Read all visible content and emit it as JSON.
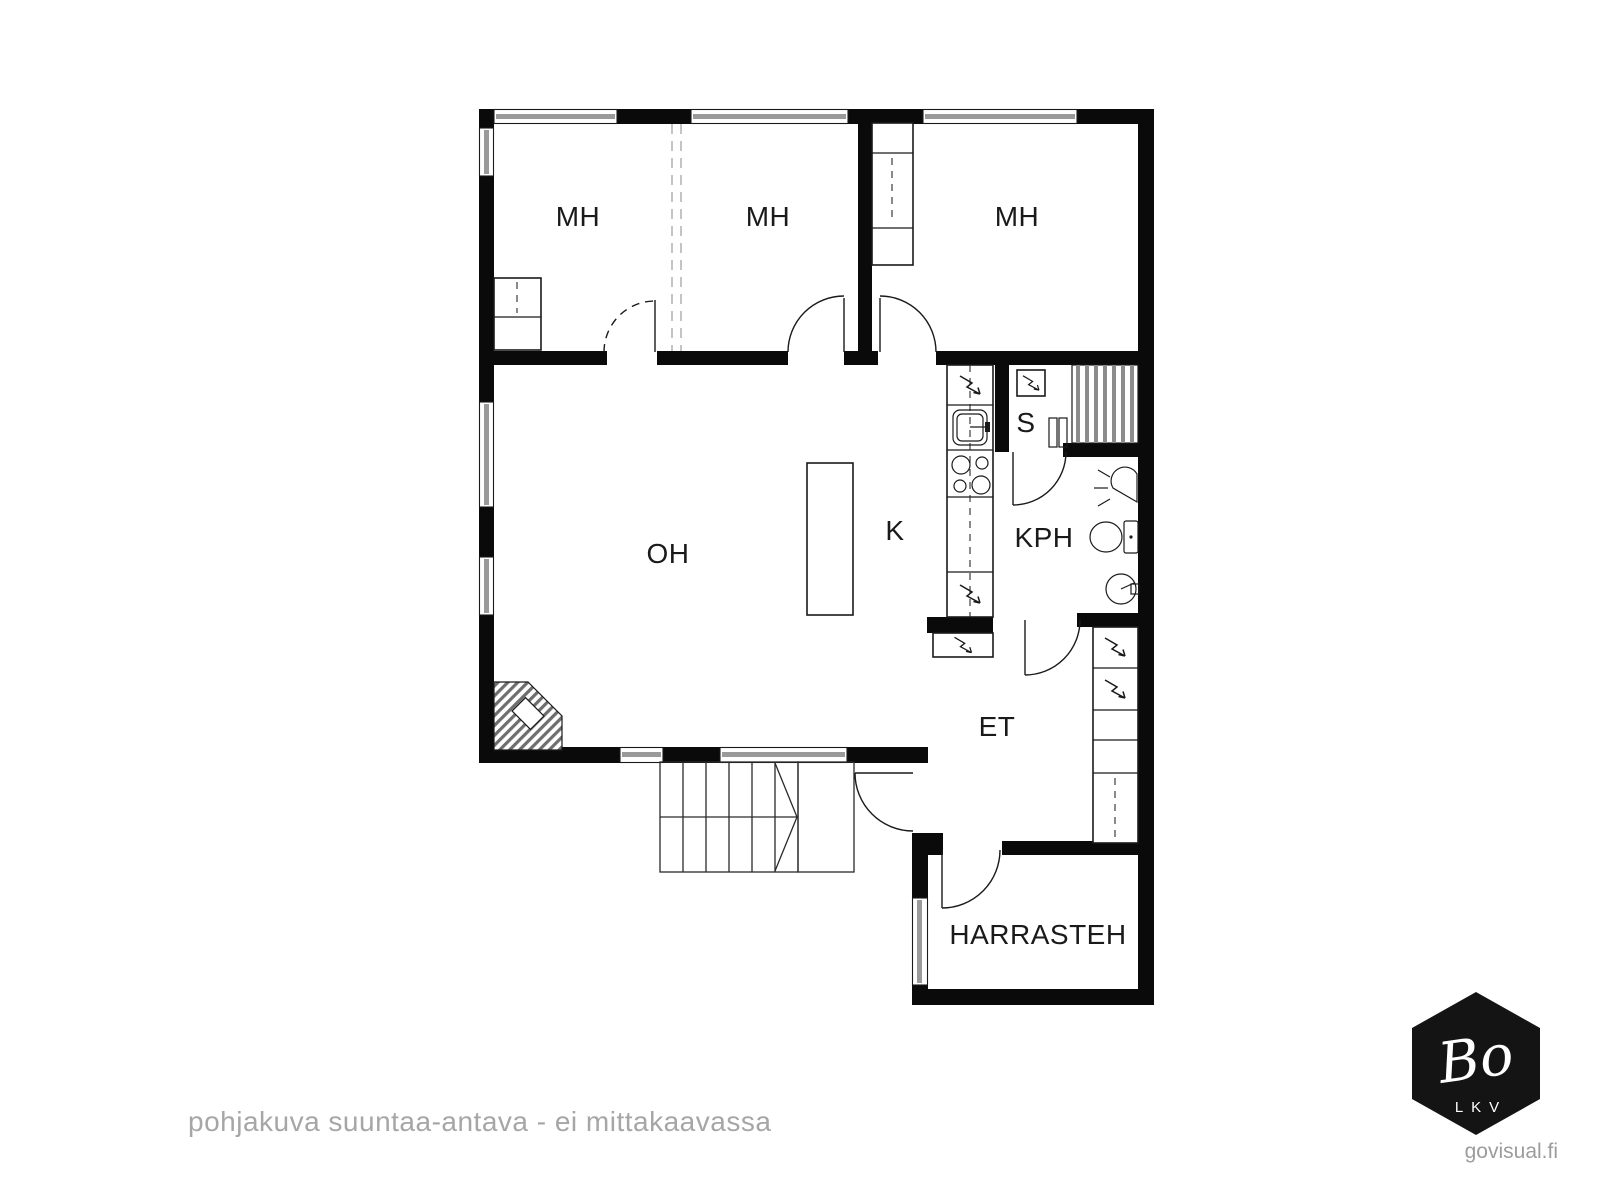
{
  "page": {
    "background": "#ffffff"
  },
  "floor_plan": {
    "disclaimer": "pohjakuva suuntaa-antava - ei mittakaavassa",
    "rooms": [
      {
        "id": "mh-1",
        "label": "MH"
      },
      {
        "id": "mh-2",
        "label": "MH"
      },
      {
        "id": "mh-3",
        "label": "MH"
      },
      {
        "id": "oh",
        "label": "OH"
      },
      {
        "id": "k",
        "label": "K"
      },
      {
        "id": "s",
        "label": "S"
      },
      {
        "id": "kph",
        "label": "KPH"
      },
      {
        "id": "et",
        "label": "ET"
      },
      {
        "id": "harrasteh",
        "label": "HARRASTEH"
      }
    ],
    "fixture_icons": [
      "electrical-symbol",
      "kitchen-sink",
      "stove-hob",
      "kitchen-island",
      "sauna-stove",
      "sauna-benches",
      "shower",
      "toilet",
      "washbasin",
      "fireplace",
      "stairs",
      "wardrobe",
      "cabinet-run",
      "door-arc",
      "window"
    ],
    "colors": {
      "wall": "#0a0a0a",
      "label": "#1a1a1a",
      "window_tint": "#9a9a9a",
      "muted_text": "#a6a6a6"
    }
  },
  "branding": {
    "logo_text": "Bo",
    "logo_subtext": "LKV",
    "watermark": "govisual.fi",
    "logo_color": "#141414"
  }
}
